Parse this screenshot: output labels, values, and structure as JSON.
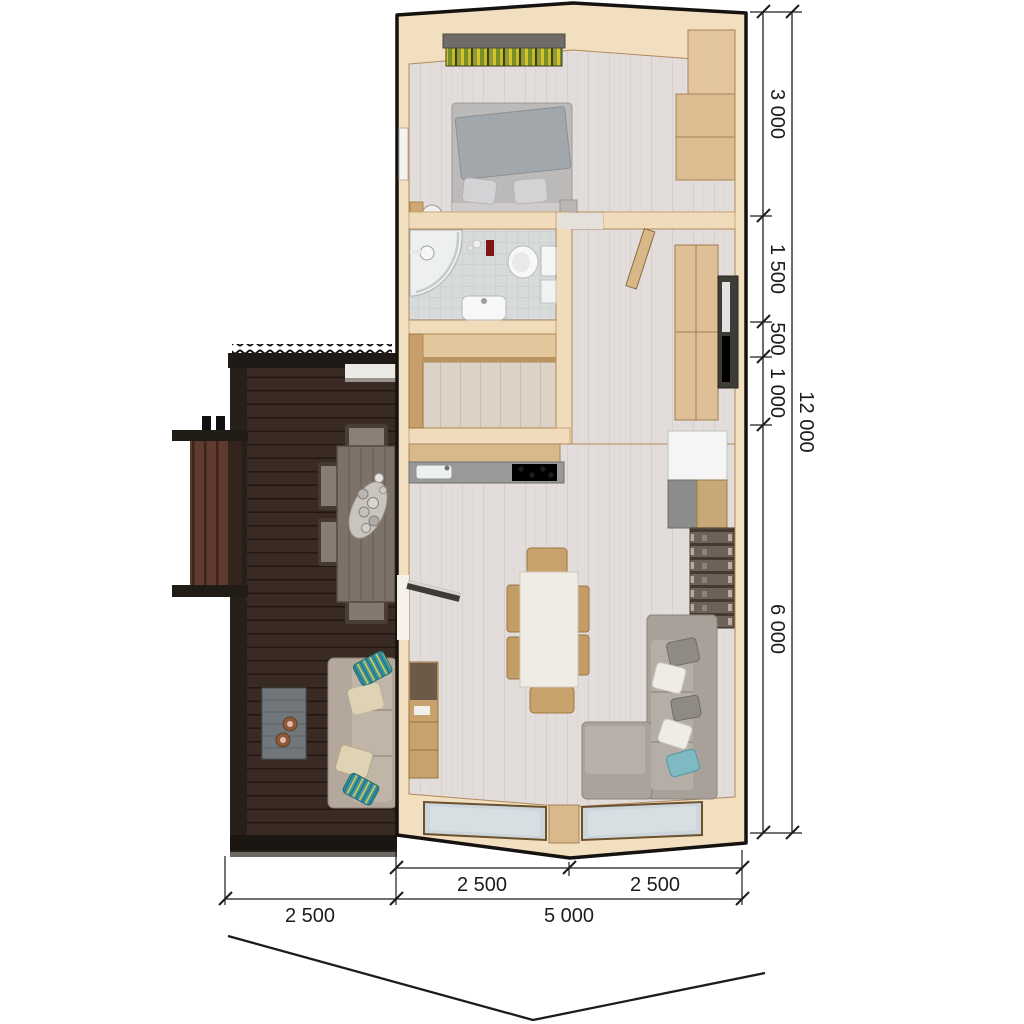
{
  "plan": {
    "type": "house-floor-plan-render",
    "dimensions": {
      "right_segments": [
        {
          "label": "3 000"
        },
        {
          "label": "1 500"
        },
        {
          "label": "500"
        },
        {
          "label": "1 000"
        },
        {
          "label": "6 000"
        }
      ],
      "right_overall": {
        "label": "12 000"
      },
      "bottom_width_segments": [
        {
          "label": "2 500"
        },
        {
          "label": "2 500"
        }
      ],
      "bottom_overall_segments": [
        {
          "label": "2 500"
        },
        {
          "label": "5 000"
        }
      ]
    },
    "colors": {
      "wall_timber": "#f2dfc0",
      "floor_whitewash": "#e2dddا",
      "deck_dark": "#3f2d26",
      "accent_teal": "#3a93a2",
      "dimension_ink": "#1c1c1c"
    }
  }
}
